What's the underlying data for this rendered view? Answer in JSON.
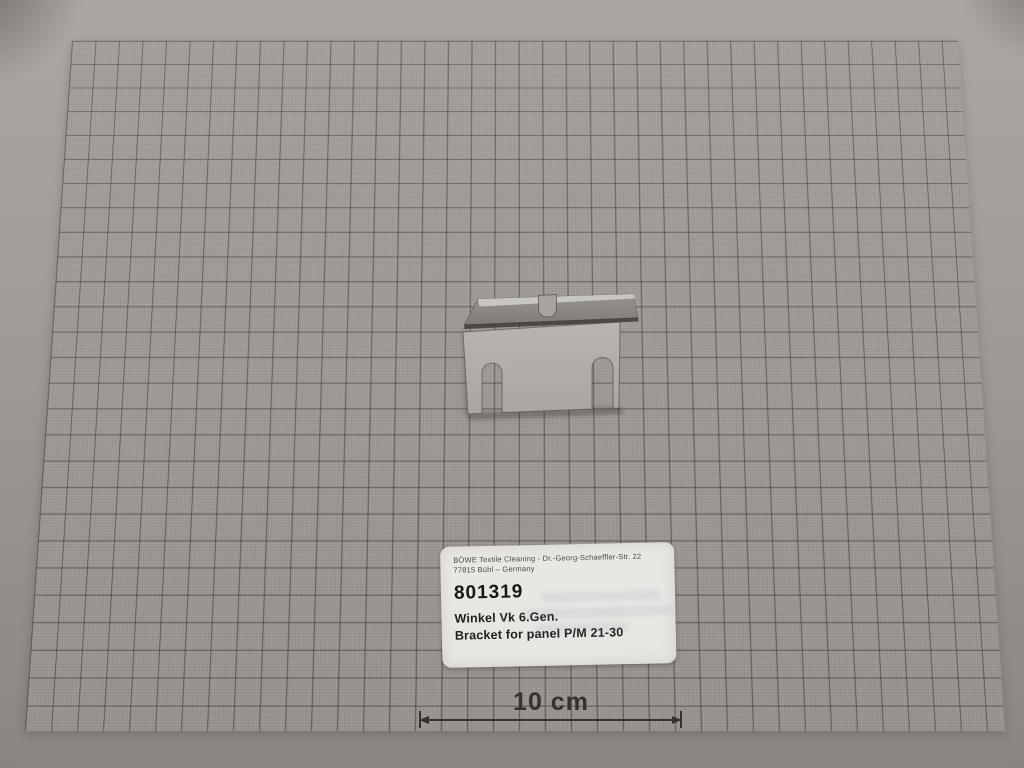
{
  "scene": {
    "description": "Photograph of a sheet-metal mounting bracket lying on millimeter graph paper with an identification label and a 10 cm scale marker"
  },
  "label": {
    "company_line": "BÖWE Textile Cleaning - Dr.-Georg-Schaeffler-Str. 22",
    "address_line": "77815 Bühl – Germany",
    "part_number": "801319",
    "name_de": "Winkel Vk 6.Gen.",
    "name_en": "Bracket for panel P/M 21-30"
  },
  "scale": {
    "label": "10 cm"
  },
  "part": {
    "name": "sheet-metal bracket with two bottom slots and folded top flange"
  },
  "colors": {
    "paper": "#aba6a2",
    "grid_major": "#57534f",
    "grid_fine": "#8e8a86",
    "background_top": "#a8a29f",
    "background_bottom": "#938e8b",
    "bracket_face": "#b8b4b0",
    "bracket_face_dark": "#a9a5a1",
    "bracket_flange": "#8e8a86",
    "bracket_flange_dark": "#7b7773",
    "bracket_highlight": "#cbc8c4",
    "bracket_outline": "#554f4b",
    "label_bg": "#f2f0ec",
    "label_text": "#1e1c1a",
    "label_small_text": "#4a4744",
    "scale_color": "#37332f"
  }
}
